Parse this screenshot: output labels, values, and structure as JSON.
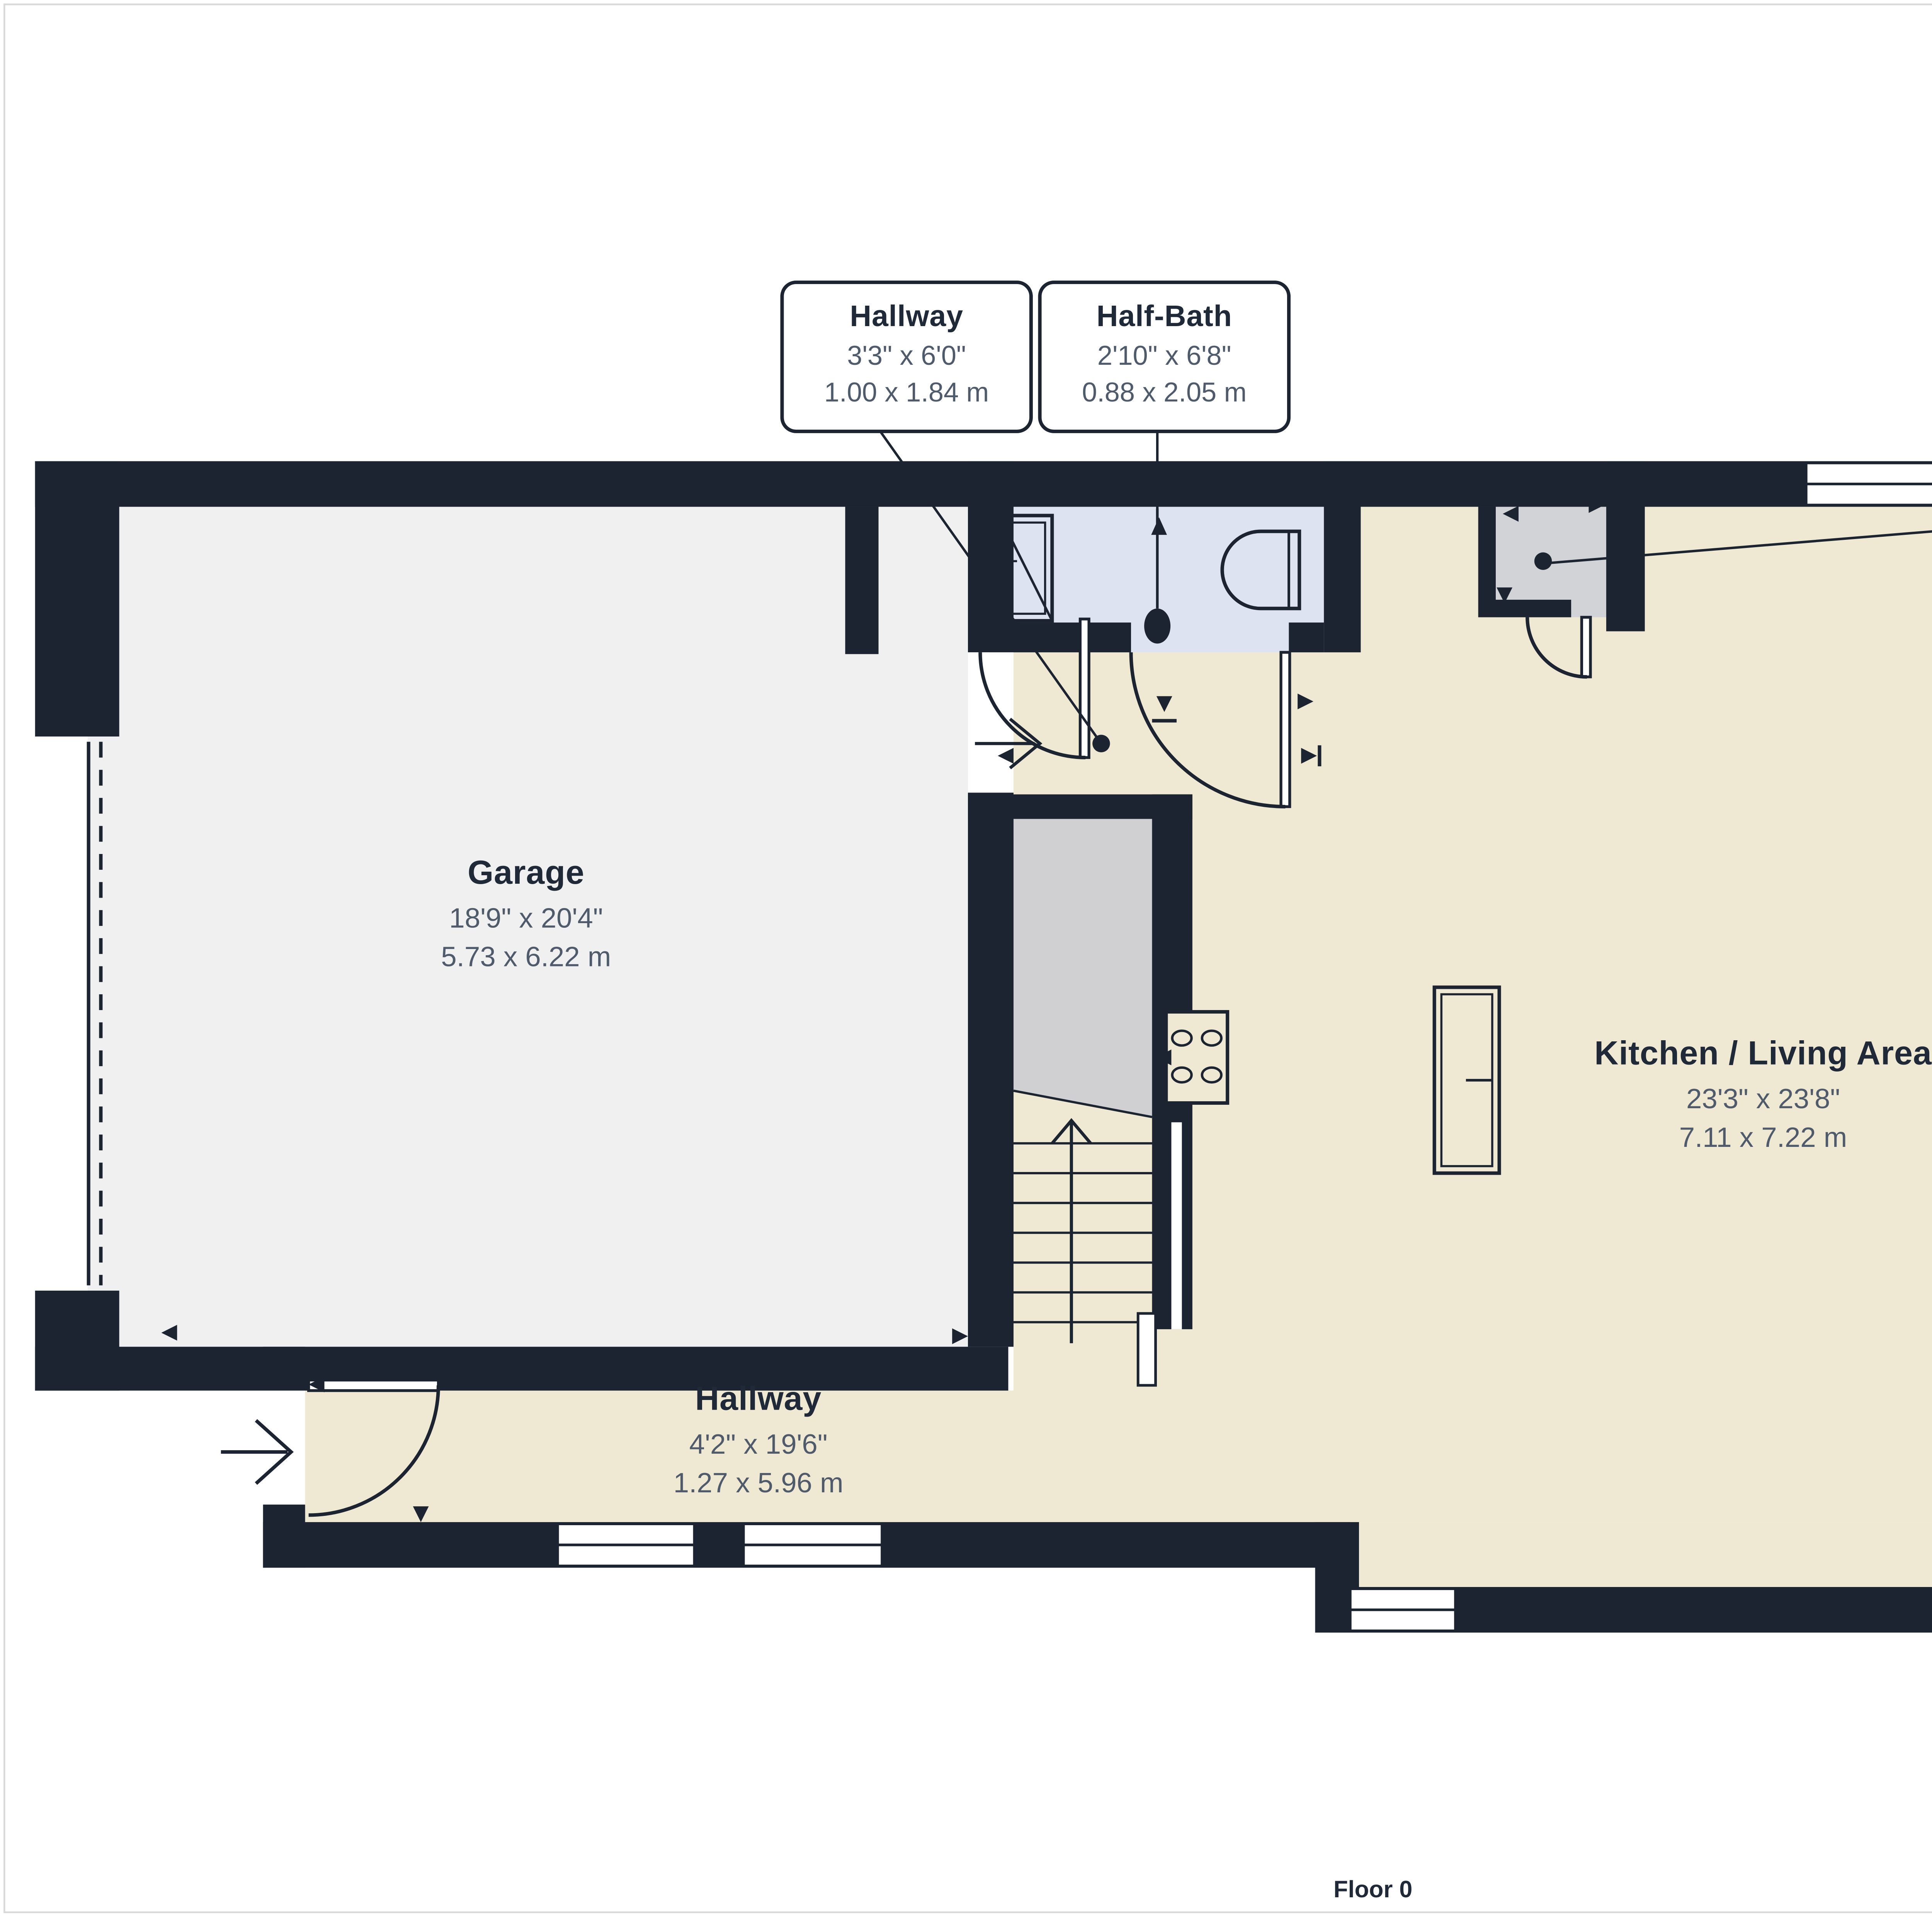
{
  "page": {
    "floor_label": "Floor 0"
  },
  "rooms": {
    "garage": {
      "name": "Garage",
      "imperial": "18'9\" x 20'4\"",
      "metric": "5.73 x 6.22 m"
    },
    "kitchen_living": {
      "name": "Kitchen / Living Area",
      "imperial": "23'3\" x 23'8\"",
      "metric": "7.11 x 7.22 m"
    },
    "hallway": {
      "name": "Hallway",
      "imperial": "4'2\" x 19'6\"",
      "metric": "1.27 x 5.96 m"
    },
    "terrace": {
      "name": "Terrace",
      "imperial": "9'0\" x 8'8\"",
      "metric": "2.76 x 2.66 m"
    }
  },
  "callouts": {
    "hallway_entry": {
      "name": "Hallway",
      "imperial": "3'3\" x 6'0\"",
      "metric": "1.00 x 1.84 m"
    },
    "half_bath": {
      "name": "Half-Bath",
      "imperial": "2'10\" x 6'8\"",
      "metric": "0.88 x 2.05 m"
    },
    "storage": {
      "imperial": "2'11\" x 2'7\"",
      "metric": "0.90 x 0.81 m"
    }
  },
  "colors": {
    "wall": "#1B2430",
    "floor_main": "#EFE8D3",
    "floor_garage": "#F0F0F1",
    "floor_bath": "#DDE3F0",
    "floor_stairs": "#D0D0D3",
    "floor_closet": "#D2D3D6",
    "title_text": "#1F2937",
    "dim_text": "#4F5B6B",
    "page_border": "#D9D9D9"
  }
}
